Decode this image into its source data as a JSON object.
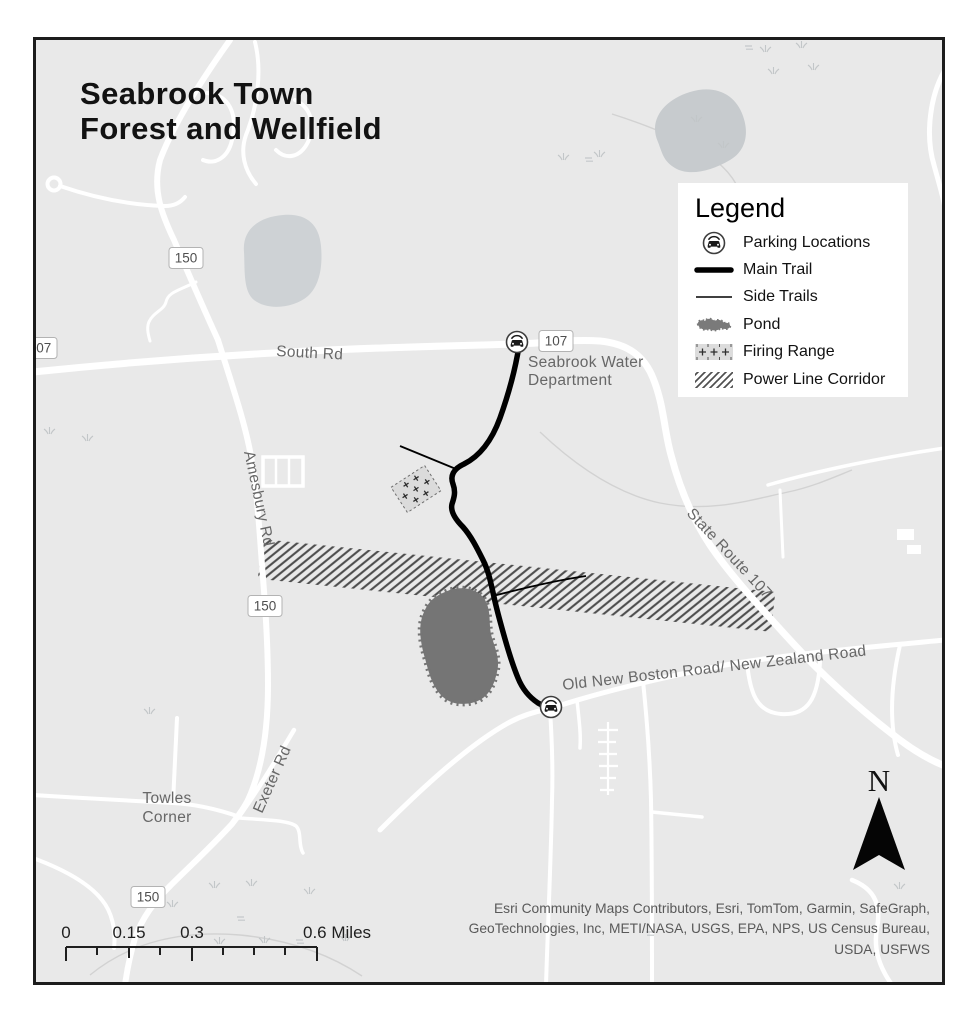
{
  "title": {
    "line1": "Seabrook Town",
    "line2": "Forest and Wellfield"
  },
  "legend": {
    "title": "Legend",
    "items": [
      {
        "label": "Parking Locations"
      },
      {
        "label": "Main Trail"
      },
      {
        "label": "Side Trails"
      },
      {
        "label": "Pond"
      },
      {
        "label": "Firing Range"
      },
      {
        "label": "Power Line Corridor"
      }
    ]
  },
  "map_labels": {
    "south_rd": "South Rd",
    "amesbury_rd": "Amesbury Rd",
    "exeter_rd": "Exeter Rd",
    "state_route_107": "State Route 107",
    "old_new_boston_rd": "Old New Boston Road/ New Zealand Road",
    "towles_corner_line1": "Towles",
    "towles_corner_line2": "Corner",
    "water_dept_line1": "Seabrook Water",
    "water_dept_line2": "Department"
  },
  "route_shields": {
    "west_107": "107",
    "south_rd_107": "107",
    "north_150": "150",
    "amesbury_150": "150",
    "exeter_150": "150"
  },
  "north_arrow_label": "N",
  "scale_bar": {
    "labels": [
      "0",
      "0.15",
      "0.3",
      "0.6 Miles"
    ]
  },
  "attribution": {
    "lines": [
      "Esri Community Maps Contributors, Esri, TomTom, Garmin, SafeGraph,",
      "GeoTechnologies, Inc, METI/NASA, USGS, EPA, NPS, US Census Bureau,",
      "USDA, USFWS"
    ]
  },
  "colors": {
    "map_background": "#e9e9e9",
    "road": "#ffffff",
    "trail": "#000000",
    "pond_dark": "#757575",
    "pond_light": "#ced2d5",
    "marsh": "#c7cbce",
    "hatch_line": "#4d4d4d",
    "legend_background": "#ffffff",
    "road_label": "#676767",
    "frame_border": "#1c1c1c"
  }
}
